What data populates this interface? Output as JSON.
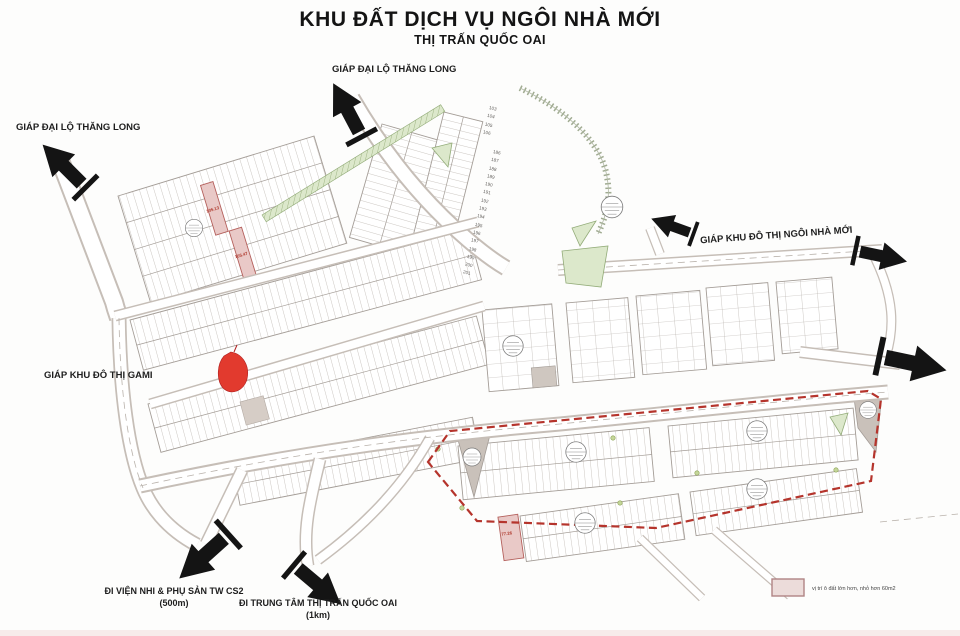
{
  "title": {
    "main": "KHU ĐẤT DỊCH VỤ NGÔI NHÀ MỚI",
    "sub": "THỊ TRẤN QUỐC OAI"
  },
  "edge_labels": {
    "top_left": "GIÁP ĐẠI LỘ THĂNG LONG",
    "top_center": "GIÁP ĐẠI LỘ THĂNG LONG",
    "right": "GIÁP KHU ĐÔ THỊ NGÔI NHÀ MỚI",
    "left": "GIÁP KHU ĐÔ THỊ GAMI",
    "bottom_left_line1": "ĐI VIỆN NHI & PHỤ SẢN TW CS2",
    "bottom_left_line2": "(500m)",
    "bottom_center_line1": "ĐI TRUNG TÂM THỊ TRẤN QUỐC OAI",
    "bottom_center_line2": "(1km)"
  },
  "highlighted_plots": {
    "plot_a": "105.13",
    "plot_b": "105.47",
    "plot_c": "77.26"
  },
  "plot_numbers": {
    "north_strip": [
      "103",
      "104",
      "105",
      "106"
    ],
    "east_strip": [
      "186",
      "187",
      "188",
      "189",
      "190",
      "191",
      "192",
      "193",
      "194",
      "195",
      "196",
      "197",
      "198",
      "199",
      "200",
      "201"
    ]
  },
  "legend": {
    "text": "vị trí ô đất lớn hơn, nhỏ hơn 60m2"
  },
  "colors": {
    "boundary_red": "#b5342c",
    "highlight_pink": "#e9c9c7",
    "legend_swatch": "#ecdcda",
    "map_green": "#dce8cb",
    "arrow_black": "#141414"
  }
}
